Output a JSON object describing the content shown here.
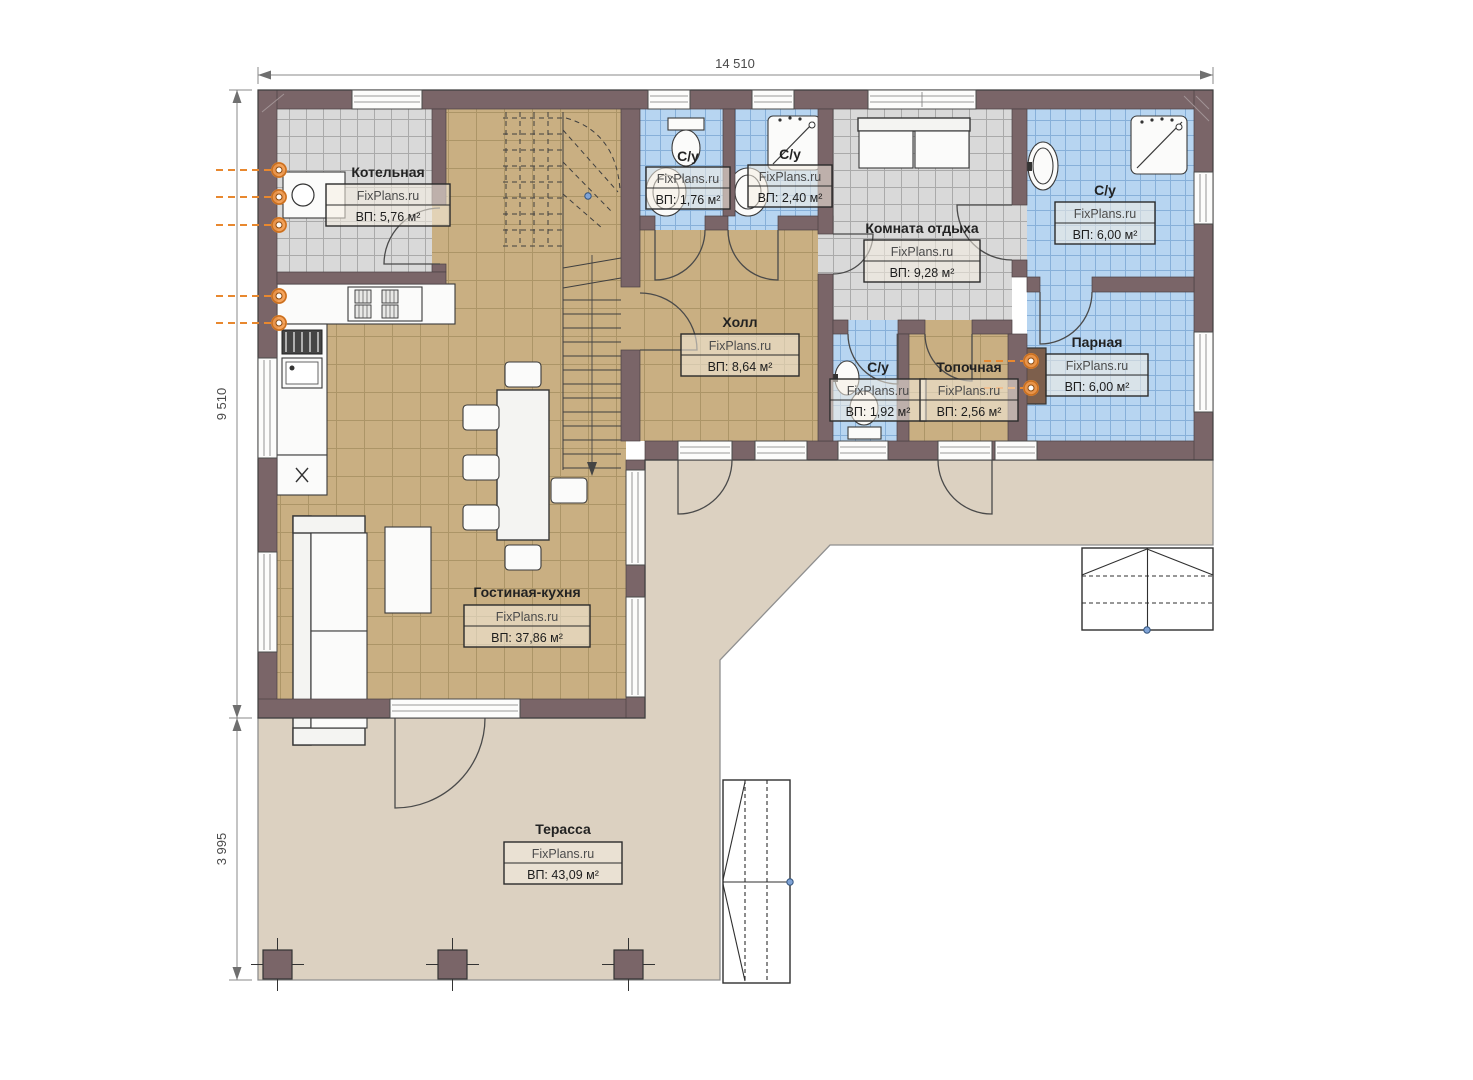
{
  "plan": {
    "watermark": "FixPlans.ru",
    "dimensions": {
      "width_total": "14 510",
      "height_upper": "9 510",
      "height_lower": "3 995"
    },
    "rooms": [
      {
        "key": "kotelnaya",
        "name": "Котельная",
        "area": "ВП: 5,76 м²"
      },
      {
        "key": "su-176",
        "name": "С/у",
        "area": "ВП: 1,76 м²"
      },
      {
        "key": "su-240",
        "name": "С/у",
        "area": "ВП: 2,40 м²"
      },
      {
        "key": "komnata-otdyha",
        "name": "Комната отдыха",
        "area": "ВП: 9,28 м²"
      },
      {
        "key": "su-600",
        "name": "С/у",
        "area": "ВП: 6,00 м²"
      },
      {
        "key": "holl",
        "name": "Холл",
        "area": "ВП: 8,64 м²"
      },
      {
        "key": "su-192",
        "name": "С/у",
        "area": "ВП: 1,92 м²"
      },
      {
        "key": "topochnaya",
        "name": "Топочная",
        "area": "ВП: 2,56 м²"
      },
      {
        "key": "parnaya",
        "name": "Парная",
        "area": "ВП: 6,00 м²"
      },
      {
        "key": "gostinaya-kuhnya",
        "name": "Гостиная-кухня",
        "area": "ВП: 37,86 м²"
      },
      {
        "key": "terassa",
        "name": "Терасса",
        "area": "ВП: 43,09 м²"
      }
    ],
    "colors": {
      "wall": "#7a6568",
      "floor_tan": "#c9af82",
      "floor_gray": "#d9d9d9",
      "floor_blue": "#b7d5f1",
      "terrace": "#dcd1c1",
      "accent_orange": "#e8882f"
    }
  }
}
